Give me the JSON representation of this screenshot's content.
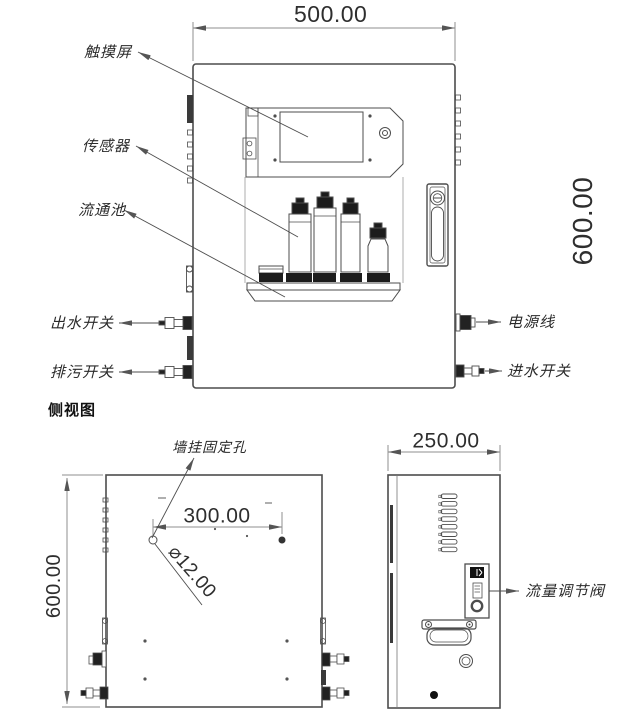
{
  "front_view": {
    "dim_width": "500.00",
    "dim_height": "600.00",
    "callouts": {
      "touch_screen": "触摸屏",
      "sensor": "传感器",
      "flow_cell": "流通池",
      "outlet_switch": "出水开关",
      "drain_switch": "排污开关",
      "power_cable": "电源线",
      "inlet_switch": "进水开关"
    }
  },
  "section_caption": "侧视图",
  "rear_view": {
    "dim_height": "600.00",
    "dim_hole_spacing": "300.00",
    "dim_hole_diameter": "⌀12.00",
    "callouts": {
      "wall_mount_hole": "墙挂固定孔"
    }
  },
  "side_view": {
    "dim_depth": "250.00",
    "callouts": {
      "flow_valve": "流量调节阀"
    }
  },
  "colors": {
    "object_line": "#4d4d4d",
    "dim_line": "#8f8f8f",
    "fill_dark": "#1c1c1c",
    "background": "#ffffff"
  }
}
